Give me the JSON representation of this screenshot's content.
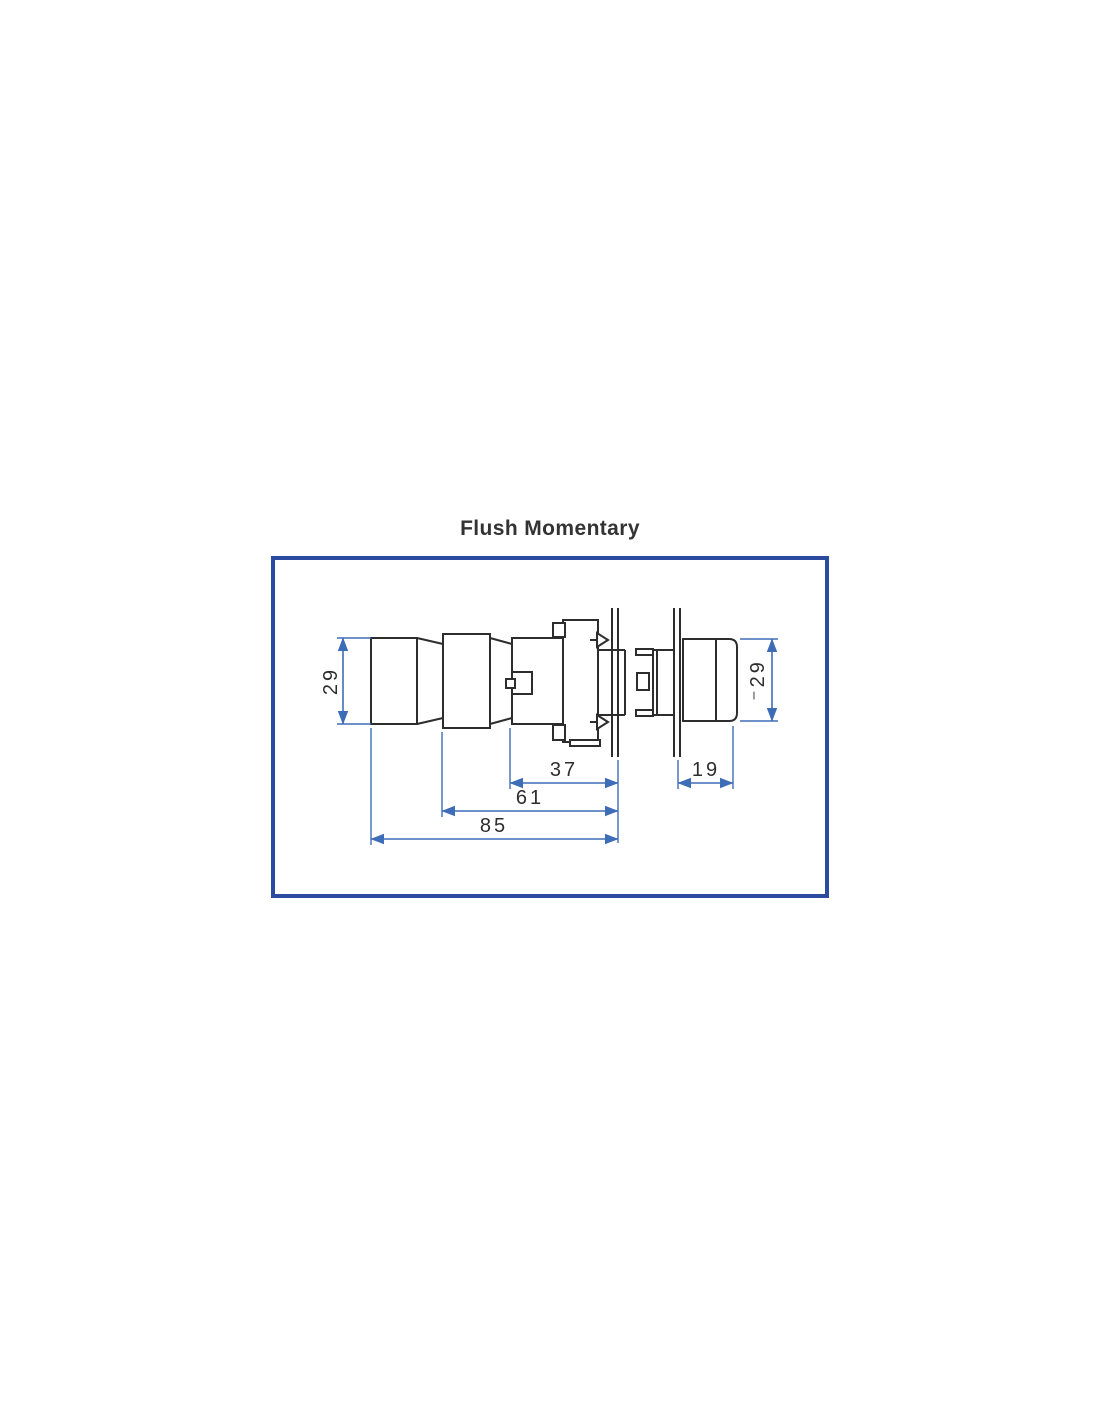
{
  "title": "Flush Momentary",
  "dimensions": {
    "body_diameter": "29",
    "head_diameter": "⁻29",
    "mount_depth": "37",
    "mid_depth": "61",
    "total_depth": "85",
    "head_projection": "19"
  },
  "colors": {
    "outline": "#2d2d2d",
    "dimension": "#3e6db8",
    "border": "#2a4b9f",
    "title_text": "#333333"
  }
}
